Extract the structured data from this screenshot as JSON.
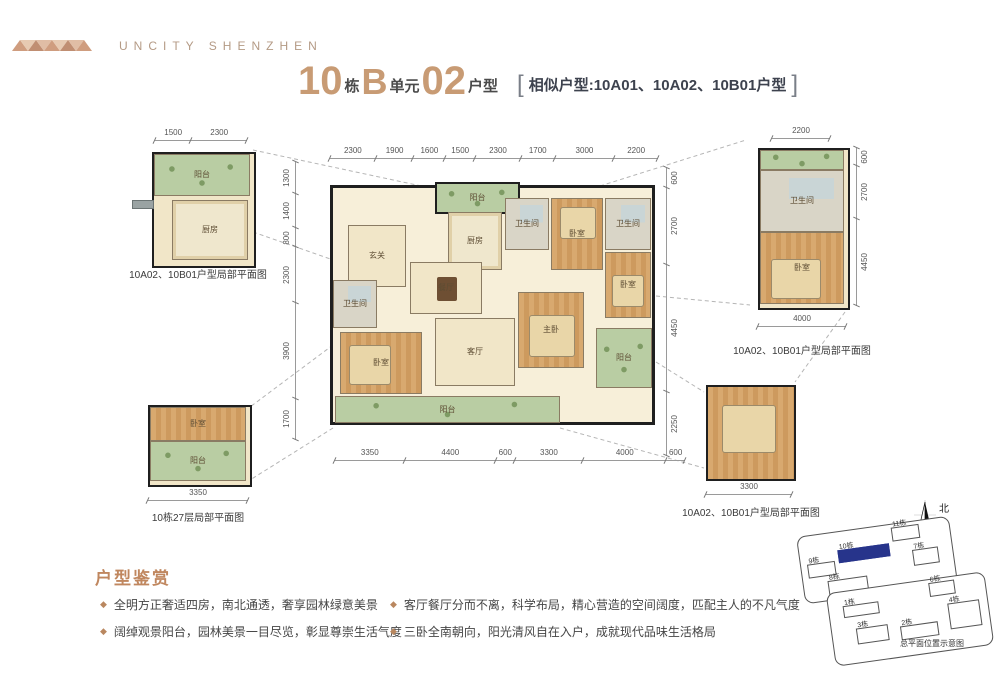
{
  "brand": {
    "name": "UNCITY SHENZHEN"
  },
  "title": {
    "num1": "10",
    "sep1": "栋",
    "num2": "B",
    "sep2": "单元",
    "num3": "02",
    "sep3": "户型",
    "bracket_open": "[",
    "similar": "相似户型:10A01、10A02、10B01户型",
    "bracket_close": "]"
  },
  "rooms": {
    "hall": "玄关",
    "kitchen": "厨房",
    "dining": "餐厅",
    "living": "客厅",
    "master": "主卧",
    "bedroom": "卧室",
    "bath": "卫生间",
    "balcony": "阳台"
  },
  "main_plan": {
    "dims_top": [
      "2300",
      "1900",
      "1600",
      "1500",
      "2300",
      "1700",
      "3000",
      "2200"
    ],
    "dims_bottom": [
      "3350",
      "4400",
      "600",
      "3300",
      "4000",
      "600"
    ],
    "dims_left": [
      "1300",
      "1400",
      "800",
      "2300",
      "3900",
      "1700"
    ],
    "dims_right": [
      "600",
      "2700",
      "4450",
      "2250"
    ]
  },
  "inset_tl": {
    "dims_top": [
      "1500",
      "2300"
    ],
    "caption": "10A02、10B01户型局部平面图"
  },
  "inset_tr": {
    "dims_top": [
      "2200"
    ],
    "dims_right": [
      "600",
      "2700",
      "4450"
    ],
    "dims_bottom": [
      "4000"
    ],
    "caption": "10A02、10B01户型局部平面图"
  },
  "inset_bl": {
    "dims_bottom": [
      "3350"
    ],
    "caption": "10栋27层局部平面图"
  },
  "inset_br": {
    "dims_bottom": [
      "3300"
    ],
    "caption": "10A02、10B01户型局部平面图"
  },
  "appreciation": {
    "heading": "户型鉴赏",
    "bullets_left": [
      "全明方正奢适四房，南北通透，奢享园林绿意美景",
      "阔绰观景阳台，园林美景一目尽览，彰显尊崇生活气度"
    ],
    "bullets_right": [
      "客厅餐厅分而不离，科学布局，精心营造的空间阔度，匹配主人的不凡气度",
      "三卧全南朝向，阳光清风自在入户，成就现代品味生活格局"
    ]
  },
  "site_map": {
    "north": "北",
    "caption": "总平面位置示意图",
    "buildings": [
      "9栋",
      "10栋",
      "11栋",
      "7栋",
      "8栋",
      "6栋",
      "1栋",
      "3栋",
      "2栋",
      "4栋"
    ]
  },
  "colors": {
    "accent": "#c49a74",
    "navy": "#27348b",
    "wall": "#1d1d1d"
  }
}
